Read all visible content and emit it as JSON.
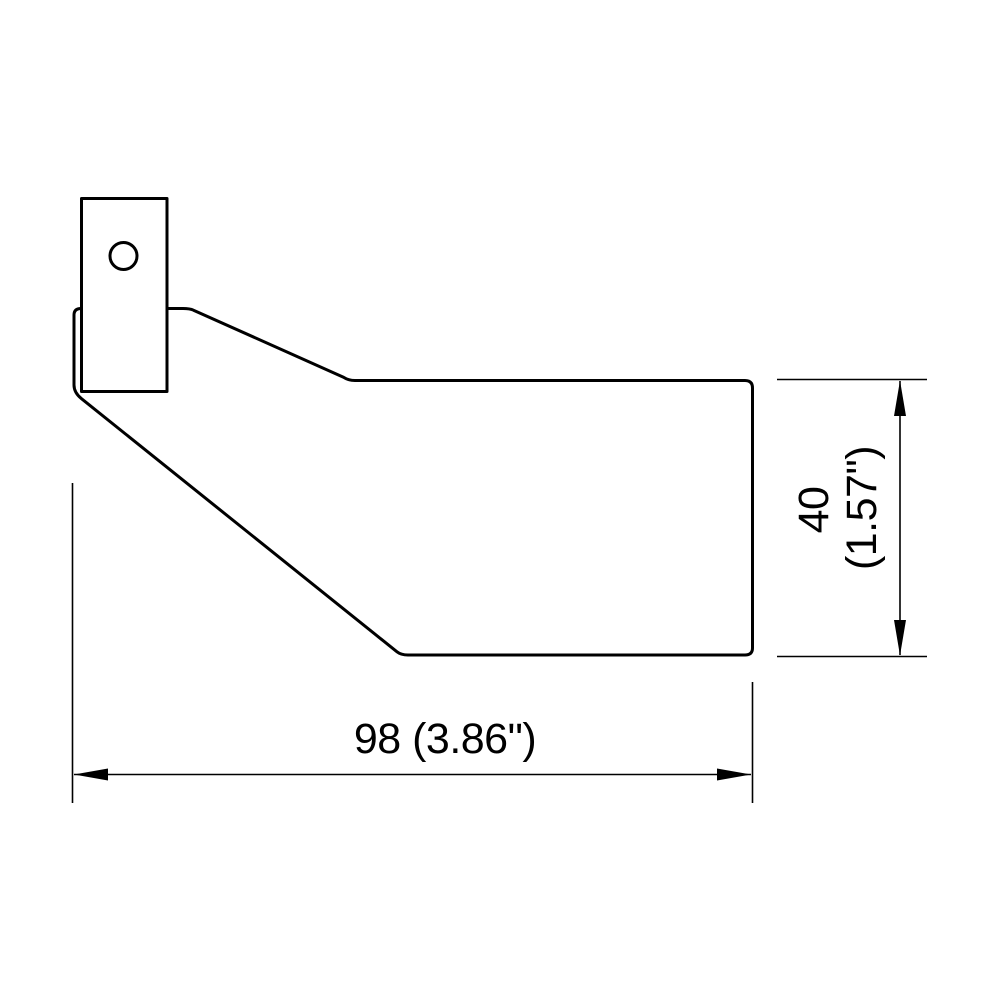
{
  "drawing": {
    "background_color": "#ffffff",
    "line_color": "#000000",
    "part": {
      "body": "exhaust-tip-side-profile",
      "bracket": "mounting-bracket-with-hole"
    },
    "dimensions": {
      "width": {
        "label": "98 (3.86\")",
        "value_mm": "98",
        "value_in": "3.86\""
      },
      "height": {
        "line1": "40",
        "line2": "(1.57\")",
        "value_mm": "40",
        "value_in": "1.57\""
      }
    }
  }
}
